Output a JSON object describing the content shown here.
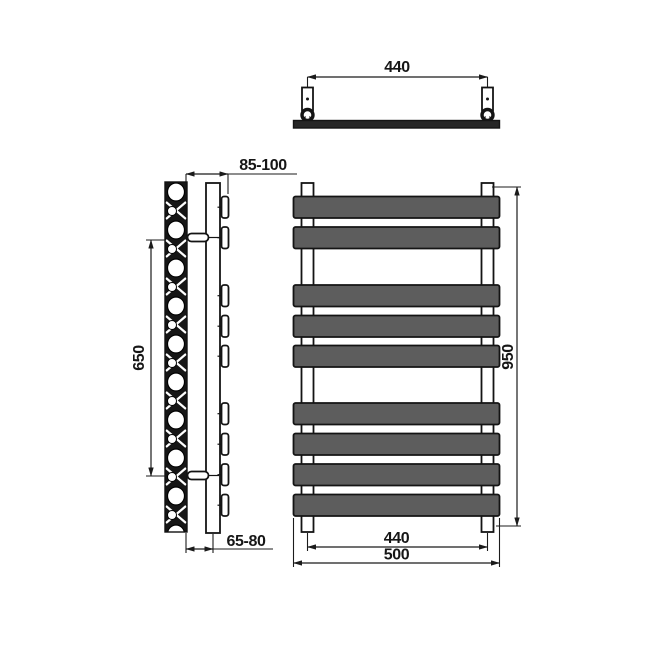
{
  "canvas": {
    "background": "#ffffff",
    "line_color": "#1b1b1b",
    "bar_fill": "#5d5d5d"
  },
  "labels": {
    "top_bracket_spacing": "440",
    "wall_offset_top": "85-100",
    "bracket_spacing_vertical": "650",
    "overall_height": "950",
    "wall_offset_bottom": "65-80",
    "tube_spacing": "440",
    "overall_width": "500"
  },
  "front_view": {
    "bar_count": 9,
    "bar_groups": [
      2,
      3,
      4
    ]
  }
}
